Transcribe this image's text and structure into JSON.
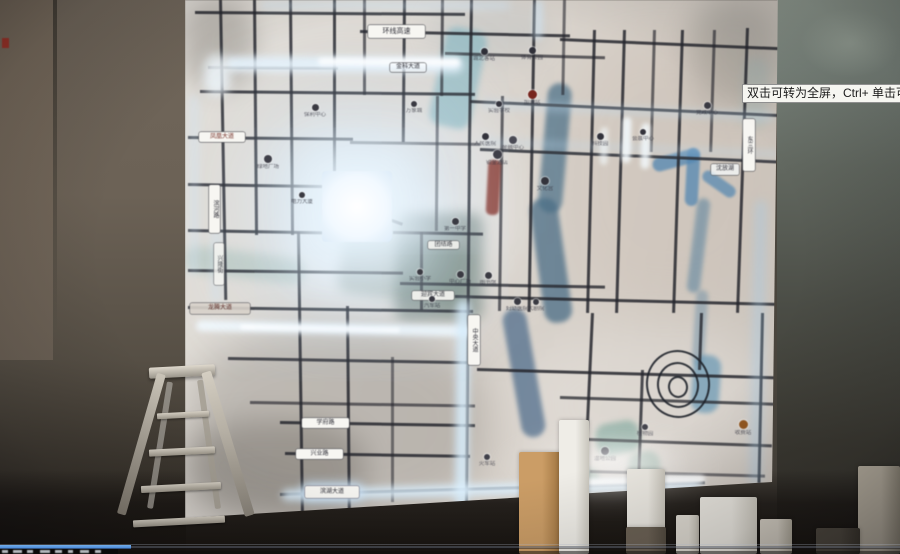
{
  "tooltip": {
    "text": "双击可转为全屏，Ctrl+ 单击可转为"
  },
  "player": {
    "progress_fraction": 0.145,
    "bar_color": "#3f7fd6",
    "fragments": [
      [
        2,
        6
      ],
      [
        13,
        9
      ],
      [
        27,
        6
      ],
      [
        40,
        10
      ],
      [
        55,
        7
      ],
      [
        68,
        5
      ],
      [
        80,
        9
      ],
      [
        95,
        6
      ]
    ]
  },
  "map": {
    "road_color": "#26272e",
    "glow_color": "#dff0ff",
    "shades": [
      [
        250,
        110,
        270,
        190,
        25,
        "#ffffff",
        0.35
      ],
      [
        300,
        180,
        160,
        120,
        18,
        "#ffffff",
        0.5
      ],
      [
        520,
        330,
        260,
        150,
        25,
        "#ffffff",
        0.22
      ],
      [
        185,
        330,
        300,
        190,
        20,
        "#5a554e",
        0.25
      ],
      [
        690,
        0,
        90,
        110,
        15,
        "#6a6a64",
        0.3
      ],
      [
        185,
        0,
        70,
        90,
        12,
        "#6a655e",
        0.3
      ],
      [
        560,
        40,
        220,
        260,
        20,
        "#c8b6a4",
        0.18
      ],
      [
        186,
        420,
        180,
        100,
        15,
        "#4a453e",
        0.3
      ],
      [
        430,
        0,
        120,
        60,
        12,
        "#9aa8b0",
        0.2
      ]
    ],
    "water": [
      [
        437,
        28,
        42,
        100,
        12,
        "#7fb6c4",
        0.6,
        3
      ],
      [
        543,
        83,
        24,
        130,
        5,
        "#50748c",
        0.75,
        2
      ],
      [
        537,
        198,
        28,
        125,
        -8,
        "#4a6e88",
        0.75,
        2
      ],
      [
        512,
        308,
        24,
        130,
        -10,
        "#47688a",
        0.7,
        2
      ],
      [
        395,
        213,
        88,
        108,
        0,
        "#3f5a52",
        0.42,
        6
      ],
      [
        340,
        240,
        130,
        60,
        8,
        "#4a6858",
        0.3,
        6
      ],
      [
        652,
        153,
        48,
        14,
        -15,
        "#4f86b4",
        0.75,
        1
      ],
      [
        686,
        148,
        13,
        58,
        3,
        "#4f86b4",
        0.75,
        1
      ],
      [
        700,
        178,
        38,
        12,
        35,
        "#4f86b4",
        0.7,
        1
      ],
      [
        692,
        198,
        13,
        95,
        7,
        "#54809f",
        0.55,
        2
      ],
      [
        694,
        290,
        12,
        75,
        4,
        "#54809f",
        0.4,
        2
      ],
      [
        692,
        355,
        28,
        58,
        4,
        "#5d93b4",
        0.65,
        2
      ],
      [
        596,
        422,
        44,
        32,
        -10,
        "#5f988c",
        0.5,
        3
      ],
      [
        628,
        452,
        32,
        26,
        -10,
        "#58907f",
        0.42,
        3
      ],
      [
        573,
        468,
        26,
        20,
        0,
        "#58907f",
        0.38,
        3
      ],
      [
        185,
        252,
        120,
        26,
        7,
        "#6fa49c",
        0.28,
        5
      ],
      [
        742,
        58,
        26,
        72,
        3,
        "#8fb4b8",
        0.25,
        5
      ]
    ],
    "roads_h": [
      [
        195,
        11,
        270,
        0.4,
        0.85
      ],
      [
        360,
        30,
        210,
        1.2,
        0.85
      ],
      [
        560,
        38,
        218,
        2.4,
        0.85
      ],
      [
        445,
        52,
        160,
        1.5,
        0.7
      ],
      [
        208,
        66,
        130,
        0.3,
        0.5
      ],
      [
        200,
        90,
        275,
        0.6,
        0.85
      ],
      [
        470,
        100,
        308,
        2.6,
        0.85
      ],
      [
        188,
        136,
        165,
        0.6,
        0.85
      ],
      [
        350,
        141,
        130,
        0.8,
        0.6
      ],
      [
        480,
        148,
        300,
        2.4,
        0.85
      ],
      [
        188,
        183,
        145,
        0.9,
        0.85
      ],
      [
        188,
        229,
        135,
        1.0,
        0.85
      ],
      [
        393,
        231,
        90,
        1.0,
        0.8
      ],
      [
        348,
        203,
        58,
        20,
        0.8
      ],
      [
        188,
        269,
        215,
        0.7,
        0.85
      ],
      [
        400,
        282,
        205,
        1.0,
        0.8
      ],
      [
        455,
        295,
        322,
        1.4,
        0.85
      ],
      [
        188,
        306,
        285,
        0.8,
        0.85
      ],
      [
        228,
        357,
        250,
        1.0,
        0.8
      ],
      [
        477,
        368,
        300,
        1.6,
        0.85
      ],
      [
        250,
        401,
        225,
        0.9,
        0.65
      ],
      [
        280,
        421,
        195,
        0.9,
        0.85
      ],
      [
        560,
        396,
        214,
        1.8,
        0.75
      ],
      [
        285,
        452,
        185,
        0.9,
        0.85
      ],
      [
        560,
        437,
        212,
        2.0,
        0.75
      ],
      [
        590,
        470,
        175,
        1.5,
        0.6
      ],
      [
        280,
        493,
        425,
        -1.6,
        0.8
      ]
    ],
    "roads_v": [
      [
        219,
        0,
        300,
        -1,
        0.85
      ],
      [
        253,
        0,
        235,
        -0.5,
        0.85
      ],
      [
        289,
        0,
        235,
        -0.5,
        0.85
      ],
      [
        333,
        0,
        172,
        0,
        0.85
      ],
      [
        363,
        0,
        95,
        0,
        0.7
      ],
      [
        403,
        0,
        142,
        0.5,
        0.85
      ],
      [
        441,
        0,
        96,
        0.5,
        0.7
      ],
      [
        470,
        0,
        150,
        0.8,
        0.85
      ],
      [
        468,
        150,
        352,
        0.5,
        0.85
      ],
      [
        501,
        96,
        215,
        0.8,
        0.7
      ],
      [
        533,
        0,
        312,
        1,
        0.85
      ],
      [
        563,
        0,
        95,
        1,
        0.6
      ],
      [
        593,
        30,
        283,
        1.4,
        0.85
      ],
      [
        623,
        30,
        283,
        1.6,
        0.85
      ],
      [
        653,
        30,
        122,
        1.6,
        0.65
      ],
      [
        681,
        30,
        283,
        1.8,
        0.85
      ],
      [
        713,
        30,
        122,
        1.8,
        0.65
      ],
      [
        746,
        28,
        285,
        2,
        0.85
      ],
      [
        761,
        313,
        170,
        1.2,
        0.9
      ],
      [
        591,
        313,
        167,
        2.6,
        0.85
      ],
      [
        641,
        370,
        110,
        2,
        0.8
      ],
      [
        700,
        313,
        57,
        2,
        0.8
      ],
      [
        420,
        232,
        78,
        0,
        0.7
      ],
      [
        297,
        232,
        285,
        -0.8,
        0.85
      ],
      [
        346,
        306,
        212,
        -0.5,
        0.85
      ],
      [
        391,
        357,
        145,
        0,
        0.55
      ],
      [
        436,
        96,
        135,
        0.5,
        0.6
      ]
    ],
    "glows": [
      [
        225,
        57,
        238,
        15,
        0.3,
        "#e8f5ff",
        0.9,
        4
      ],
      [
        318,
        58,
        142,
        8,
        0.3,
        "#ffffff",
        0.95,
        2
      ],
      [
        204,
        54,
        26,
        42,
        0,
        "#f2faff",
        0.8,
        5
      ],
      [
        196,
        323,
        278,
        11,
        1.2,
        "#f2faff",
        0.9,
        3
      ],
      [
        240,
        326,
        160,
        5,
        1.2,
        "#ffffff",
        0.95,
        1.5
      ],
      [
        456,
        300,
        13,
        208,
        0.5,
        "#d6eeff",
        0.85,
        4
      ],
      [
        282,
        484,
        420,
        11,
        -1.6,
        "#dbf0ff",
        0.9,
        4
      ],
      [
        520,
        478,
        185,
        7,
        -1.6,
        "#ffffff",
        0.95,
        2
      ],
      [
        753,
        200,
        10,
        285,
        1.2,
        "#a8cce8",
        0.5,
        5
      ],
      [
        480,
        106,
        295,
        9,
        2.6,
        "#bfdcf2",
        0.35,
        4
      ],
      [
        480,
        144,
        300,
        8,
        2.4,
        "#bfdcf2",
        0.3,
        4
      ],
      [
        622,
        117,
        9,
        46,
        1.5,
        "#f4fbff",
        0.85,
        2
      ],
      [
        641,
        123,
        9,
        46,
        1.5,
        "#f4fbff",
        0.8,
        2
      ],
      [
        600,
        127,
        8,
        38,
        1.5,
        "#f4fbff",
        0.6,
        2
      ],
      [
        260,
        2,
        250,
        7,
        0,
        "#cfe6f8",
        0.5,
        4
      ],
      [
        533,
        0,
        10,
        40,
        1,
        "#cfe6f8",
        0.5,
        3
      ],
      [
        189,
        95,
        10,
        180,
        0,
        "#cfe6f8",
        0.35,
        4
      ],
      [
        210,
        228,
        12,
        75,
        0,
        "#cfe6f8",
        0.3,
        4
      ]
    ],
    "highlight": {
      "x": 322,
      "y": 171,
      "w": 70,
      "h": 71
    },
    "red_feature": [
      487,
      160,
      13,
      55,
      3,
      "#8a3026"
    ],
    "spiral_rings": [
      [
        646,
        350,
        64,
        68
      ],
      [
        657,
        362,
        42,
        46
      ],
      [
        668,
        376,
        20,
        22
      ]
    ],
    "badges": [
      {
        "x": 368,
        "y": 25,
        "w": 57,
        "h": 13,
        "t": "环线高速",
        "fs": 7
      },
      {
        "x": 199,
        "y": 132,
        "w": 46,
        "h": 10,
        "t": "凤凰大道",
        "fg": "#7a342a"
      },
      {
        "x": 209,
        "y": 185,
        "w": 11,
        "h": 48,
        "t": "滨河路",
        "v": true
      },
      {
        "x": 214,
        "y": 243,
        "w": 10,
        "h": 42,
        "t": "兴隆街",
        "v": true,
        "op": 0.8
      },
      {
        "x": 468,
        "y": 315,
        "w": 12,
        "h": 50,
        "t": "中央大道",
        "v": true
      },
      {
        "x": 743,
        "y": 119,
        "w": 12,
        "h": 52,
        "t": "东三环",
        "v": true
      },
      {
        "x": 302,
        "y": 418,
        "w": 47,
        "h": 10,
        "t": "学府路"
      },
      {
        "x": 296,
        "y": 449,
        "w": 47,
        "h": 10,
        "t": "兴业路"
      },
      {
        "x": 305,
        "y": 486,
        "w": 54,
        "h": 12,
        "t": "滨湖大道",
        "glow": true
      },
      {
        "x": 412,
        "y": 291,
        "w": 42,
        "h": 9,
        "t": "迎宾大道",
        "op": 0.9
      },
      {
        "x": 428,
        "y": 241,
        "w": 31,
        "h": 8,
        "t": "团结路",
        "op": 0.85
      },
      {
        "x": 711,
        "y": 164,
        "w": 28,
        "h": 11,
        "t": "沈放湖",
        "bg": "rgba(246,249,251,0.75)"
      },
      {
        "x": 390,
        "y": 63,
        "w": 36,
        "h": 9,
        "t": "金科大道",
        "bg": "rgba(255,255,255,0.25)"
      },
      {
        "x": 190,
        "y": 303,
        "w": 60,
        "h": 11,
        "t": "龙腾大道",
        "fg": "#5a241c",
        "bg": "#d8d2ca",
        "op": 0.9
      }
    ],
    "markers": [
      [
        315,
        107,
        7,
        "#3a3a42",
        "保利中心"
      ],
      [
        268,
        159,
        8,
        "#3f3f48",
        "绿地广场"
      ],
      [
        414,
        104,
        6,
        "#3a3a42",
        "万象城"
      ],
      [
        484,
        51,
        7,
        "#2f2f38",
        "城北客站"
      ],
      [
        532,
        50,
        7,
        "#2f2f38",
        "体育公园"
      ],
      [
        532,
        94,
        9,
        "#7a241c",
        "加油站"
      ],
      [
        499,
        104,
        6,
        "#33333c",
        "实验学校"
      ],
      [
        485,
        136,
        7,
        "#33333c",
        "人民医院"
      ],
      [
        513,
        140,
        8,
        "#4a4a54",
        "金融中心"
      ],
      [
        497,
        154,
        9,
        "#3f3f48",
        "铂金酒店"
      ],
      [
        545,
        181,
        8,
        "#33333c",
        "文化宫"
      ],
      [
        600,
        136,
        7,
        "#33333c",
        "科技园"
      ],
      [
        643,
        132,
        6,
        "#33333c",
        "会展中心"
      ],
      [
        707,
        105,
        7,
        "#3a3a42",
        "党政中心"
      ],
      [
        455,
        221,
        7,
        "#3a3a42",
        "第一中学"
      ],
      [
        420,
        272,
        6,
        "#3a3a42",
        "实验小学"
      ],
      [
        460,
        274,
        7,
        "#3a3a42",
        "中心广场"
      ],
      [
        488,
        275,
        7,
        "#3a3a42",
        "图书馆"
      ],
      [
        517,
        301,
        7,
        "#3a3a42",
        "妇幼医院"
      ],
      [
        536,
        302,
        6,
        "#3a3a42",
        "大剧院"
      ],
      [
        432,
        299,
        6,
        "#3a3a42",
        "汽车站"
      ],
      [
        302,
        195,
        6,
        "#3a3a42",
        "电力大厦"
      ],
      [
        605,
        451,
        8,
        "#3f3f48",
        "湿地公园"
      ],
      [
        645,
        427,
        6,
        "#3f3f48",
        "植物园"
      ],
      [
        487,
        457,
        6,
        "#3f3f48",
        "火车站"
      ],
      [
        743,
        424,
        9,
        "#96581e",
        "收费站"
      ]
    ]
  },
  "foreground": {
    "glows": [
      [
        488,
        428,
        235,
        78,
        "#ffffff",
        0.5,
        12
      ],
      [
        556,
        438,
        130,
        52,
        "#ffffff",
        0.6,
        8
      ]
    ],
    "boxes": [
      [
        519,
        452,
        42,
        102,
        "#cb9d66",
        "#9f7440"
      ],
      [
        559,
        420,
        30,
        134,
        "#efede7",
        "#c9c6bd"
      ],
      [
        627,
        469,
        38,
        60,
        "#eae7e0",
        "#c6c2b8"
      ],
      [
        626,
        527,
        40,
        27,
        "#6b6154",
        "#51493e"
      ],
      [
        676,
        515,
        23,
        39,
        "#ddd9d0",
        "#bdb8ad"
      ],
      [
        700,
        497,
        57,
        57,
        "#e8e5de",
        "#c8c4ba"
      ],
      [
        760,
        519,
        32,
        35,
        "#cfc9be",
        "#aaa496"
      ],
      [
        858,
        466,
        42,
        88,
        "#b6ae9f",
        "#8e8778"
      ],
      [
        816,
        528,
        44,
        26,
        "#4d473e",
        "#39342c"
      ]
    ]
  }
}
